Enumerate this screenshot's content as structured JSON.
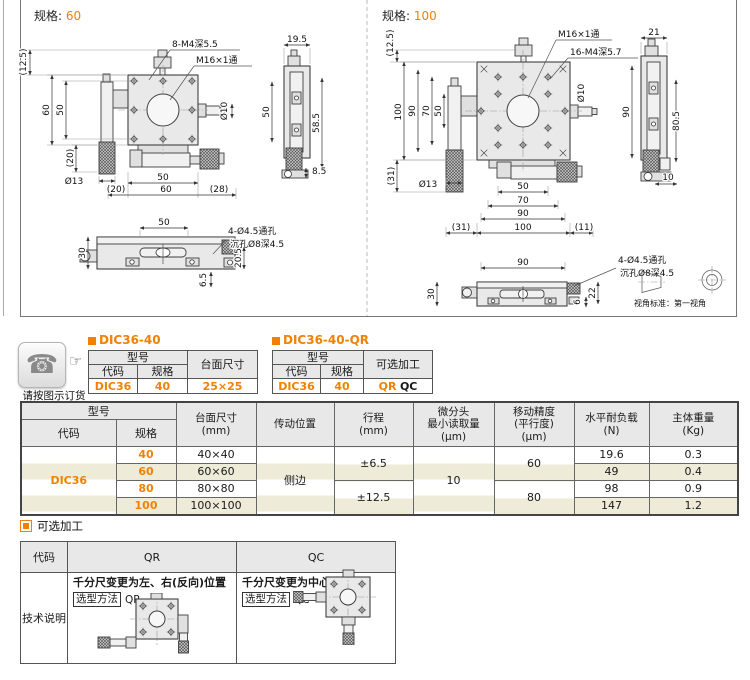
{
  "accent": "#ef8200",
  "beige": "#eeebd9",
  "specs": {
    "left_label": "规格:",
    "left_value": "60",
    "right_label": "规格:",
    "right_value": "100"
  },
  "d60": [
    "(12.5)",
    "60",
    "50",
    "(20)",
    "Ø13",
    "8-M4深5.5",
    "M16×1通",
    "Ø10",
    "19.5",
    "50",
    "58.5",
    "8.5",
    "50",
    "(20)",
    "60",
    "(28)",
    "50",
    "4-Ø4.5通孔",
    "沉孔Ø8深4.5",
    "30",
    "20.5",
    "6.5"
  ],
  "d100": [
    "(12.5)",
    "100",
    "90",
    "70",
    "50",
    "(31)",
    "Ø13",
    "M16×1通",
    "16-M4深5.7",
    "21",
    "Ø10",
    "90",
    "80.5",
    "10",
    "50",
    "70",
    "90",
    "(31)",
    "100",
    "(11)",
    "90",
    "4-Ø4.5通孔",
    "沉孔Ø8深4.5",
    "30",
    "22",
    "6",
    "视角标准：第一视角"
  ],
  "order": {
    "note": "请按图示订货",
    "t1": {
      "title": "DIC36-40",
      "h_model": "型号",
      "h_code": "代码",
      "h_spec": "规格",
      "h_surface": "台面尺寸",
      "code": "DIC36",
      "spec": "40",
      "surface": "25×25"
    },
    "t2": {
      "title": "DIC36-40-QR",
      "h_model": "型号",
      "h_code": "代码",
      "h_spec": "规格",
      "h_opt": "可选加工",
      "code": "DIC36",
      "spec": "40",
      "opt1": "QR",
      "opt2": "QC"
    }
  },
  "spec_table": {
    "h_model": "型号",
    "h_code": "代码",
    "h_spec": "规格",
    "h_surface1": "台面尺寸",
    "h_surface2": "(mm)",
    "h_drive": "传动位置",
    "h_travel1": "行程",
    "h_travel2": "(mm)",
    "h_read1": "微分头",
    "h_read2": "最小读取量",
    "h_read3": "(μm)",
    "h_acc1": "移动精度",
    "h_acc2": "(平行度)",
    "h_acc3": "(μm)",
    "h_load1": "水平耐负载",
    "h_load2": "(N)",
    "h_mass1": "主体重量",
    "h_mass2": "(Kg)",
    "code": "DIC36",
    "drive": "侧边",
    "min_reading": "10",
    "travel": [
      "±6.5",
      "±12.5"
    ],
    "accuracy": [
      "60",
      "80"
    ],
    "rows": [
      {
        "spec": "40",
        "surface": "40×40",
        "load": "19.6",
        "mass": "0.3"
      },
      {
        "spec": "60",
        "surface": "60×60",
        "load": "49",
        "mass": "0.4"
      },
      {
        "spec": "80",
        "surface": "80×80",
        "load": "98",
        "mass": "0.9"
      },
      {
        "spec": "100",
        "surface": "100×100",
        "load": "147",
        "mass": "1.2"
      }
    ]
  },
  "optional": {
    "title": "可选加工",
    "h_code": "代码",
    "h_qr": "QR",
    "h_qc": "QC",
    "row_label": "技术说明",
    "qr_desc": "千分尺变更为左、右(反向)位置",
    "qr_method_label": "选型方法",
    "qr_method_value": "QR",
    "qc_desc": "千分尺变更为中心位置",
    "qc_method_label": "选型方法",
    "qc_method_value": "QC"
  }
}
